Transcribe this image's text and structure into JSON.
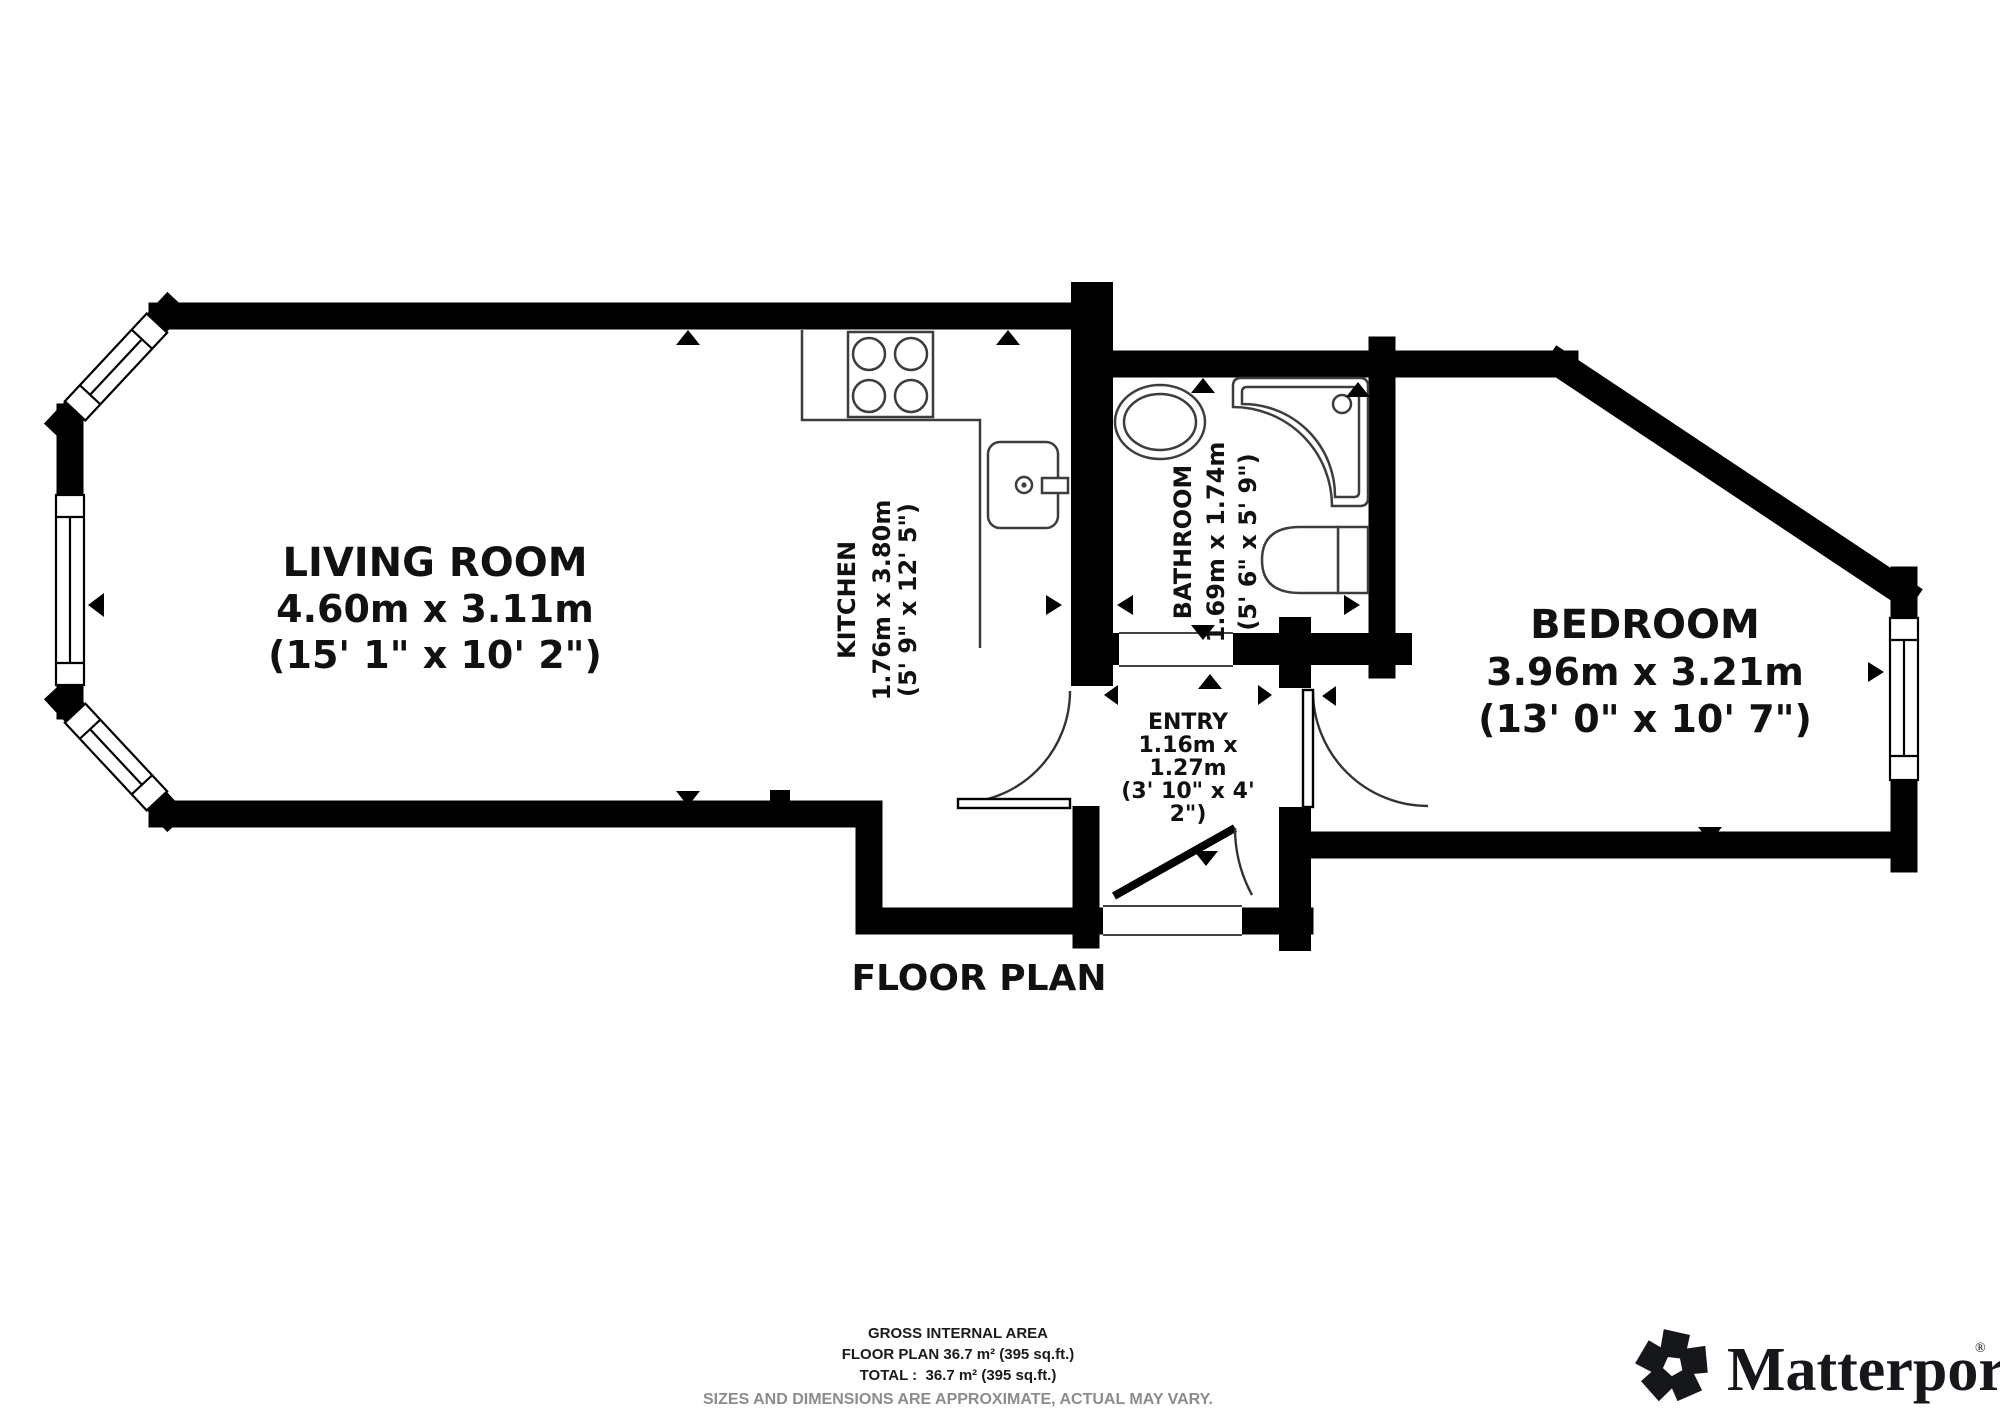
{
  "rooms": {
    "living_room": {
      "name": "LIVING ROOM",
      "metric": "4.60m x 3.11m",
      "imperial": "(15' 1\" x 10' 2\")"
    },
    "kitchen": {
      "name": "KITCHEN",
      "metric": "1.76m x 3.80m",
      "imperial": "(5' 9\" x 12' 5\")"
    },
    "bathroom": {
      "name": "BATHROOM",
      "metric": "1.69m x 1.74m",
      "imperial": "(5' 6\" x 5' 9\")"
    },
    "entry": {
      "lines": [
        "ENTRY",
        "1.16m x",
        "1.27m",
        "(3' 10\" x 4'",
        "2\")"
      ]
    },
    "bedroom": {
      "name": "BEDROOM",
      "metric": "3.96m x 3.21m",
      "imperial": "(13' 0\" x 10' 7\")"
    }
  },
  "plan_title": "FLOOR PLAN",
  "footer": {
    "gross_internal_area_label": "GROSS INTERNAL AREA",
    "floor_plan_area": "FLOOR PLAN 36.7 m² (395 sq.ft.)",
    "total_area": "TOTAL :  36.7 m² (395 sq.ft.)",
    "disclaimer": "SIZES AND DIMENSIONS ARE APPROXIMATE, ACTUAL MAY VARY."
  },
  "branding": {
    "logo_text": "Matterport",
    "registered_mark": "®"
  },
  "colors": {
    "wall": "#000000",
    "fixture_line": "#3d3d3d",
    "disclaimer_gray": "#8c8c8c",
    "background": "#ffffff"
  }
}
